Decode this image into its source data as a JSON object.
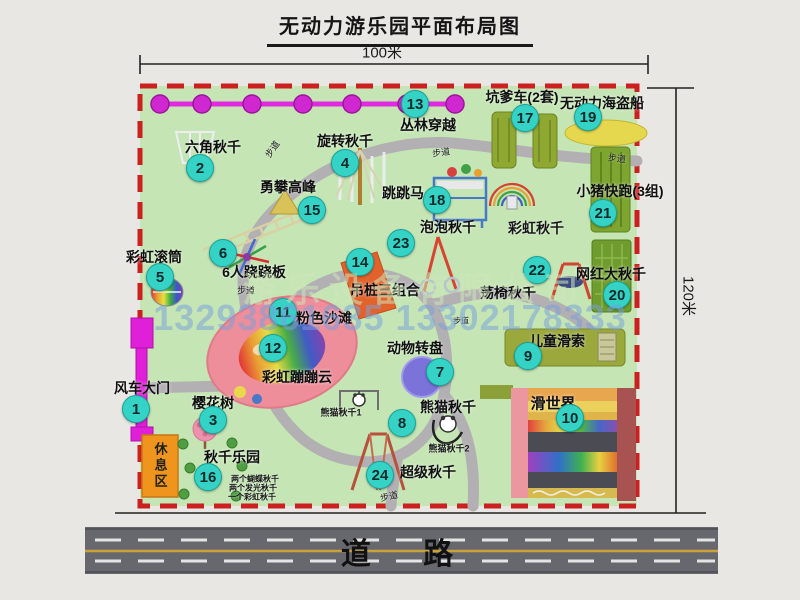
{
  "title": "无动力游乐园平面布局图",
  "dimensions": {
    "width_label": "100米",
    "height_label": "120米"
  },
  "road": {
    "label": "道 路"
  },
  "rest_area": {
    "label": "休息区"
  },
  "watermark": {
    "company": "游乐设备有限公司",
    "phone": "13293861635 13302178333"
  },
  "colors": {
    "map_green": "#c5e5b5",
    "border_red": "#cc1f1f",
    "badge_cyan": "#35d2c6",
    "chain_pink": "#d028d0",
    "road_gray": "#67676e",
    "gate_magenta": "#e020d8",
    "rest_orange": "#ef941d",
    "walkway_gray": "#b2b0b2"
  },
  "map": {
    "items": [
      {
        "num": 1,
        "name": "风车大门",
        "bx": 136,
        "by": 409,
        "lx": 142,
        "ly": 388
      },
      {
        "num": 2,
        "name": "六角秋千",
        "bx": 200,
        "by": 168,
        "lx": 213,
        "ly": 147
      },
      {
        "num": 3,
        "name": "樱花树",
        "bx": 213,
        "by": 420,
        "lx": 213,
        "ly": 403
      },
      {
        "num": 4,
        "name": "旋转秋千",
        "bx": 345,
        "by": 163,
        "lx": 345,
        "ly": 141
      },
      {
        "num": 5,
        "name": "彩虹滚筒",
        "bx": 160,
        "by": 277,
        "lx": 154,
        "ly": 257
      },
      {
        "num": 6,
        "name": "6人跷跷板",
        "bx": 223,
        "by": 253,
        "lx": 254,
        "ly": 272
      },
      {
        "num": 7,
        "name": "动物转盘",
        "bx": 440,
        "by": 372,
        "lx": 415,
        "ly": 348
      },
      {
        "num": 8,
        "name": "熊猫秋千",
        "bx": 402,
        "by": 423,
        "lx": 448,
        "ly": 407
      },
      {
        "num": 9,
        "name": "儿童滑索",
        "bx": 528,
        "by": 356,
        "lx": 557,
        "ly": 341
      },
      {
        "num": 10,
        "name": "滑世界",
        "bx": 570,
        "by": 418,
        "lx": 553,
        "ly": 403,
        "size": 15
      },
      {
        "num": 11,
        "name": "粉色沙滩",
        "bx": 283,
        "by": 312,
        "lx": 324,
        "ly": 318
      },
      {
        "num": 12,
        "name": "彩虹蹦蹦云",
        "bx": 273,
        "by": 348,
        "lx": 297,
        "ly": 377
      },
      {
        "num": 13,
        "name": "丛林穿越",
        "bx": 415,
        "by": 104,
        "lx": 428,
        "ly": 125
      },
      {
        "num": 14,
        "name": "吊桩三组合",
        "bx": 360,
        "by": 262,
        "lx": 385,
        "ly": 290
      },
      {
        "num": 15,
        "name": "勇攀高峰",
        "bx": 312,
        "by": 210,
        "lx": 288,
        "ly": 187
      },
      {
        "num": 16,
        "name": "秋千乐园",
        "bx": 208,
        "by": 477,
        "lx": 232,
        "ly": 457
      },
      {
        "num": 17,
        "name": "坑爹车(2套)",
        "bx": 525,
        "by": 118,
        "lx": 522,
        "ly": 97
      },
      {
        "num": 18,
        "name": "跳跳马",
        "bx": 437,
        "by": 200,
        "lx": 403,
        "ly": 193
      },
      {
        "num": 19,
        "name": "无动力海盗船",
        "bx": 588,
        "by": 117,
        "lx": 602,
        "ly": 103
      },
      {
        "num": 20,
        "name": "网红大秋千",
        "bx": 617,
        "by": 295,
        "lx": 611,
        "ly": 274
      },
      {
        "num": 21,
        "name": "小猪快跑(3组)",
        "bx": 603,
        "by": 213,
        "lx": 620,
        "ly": 191
      },
      {
        "num": 22,
        "name": "荡椅秋千",
        "bx": 537,
        "by": 270,
        "lx": 508,
        "ly": 293
      },
      {
        "num": 23,
        "name": "泡泡秋千",
        "bx": 401,
        "by": 243,
        "lx": 448,
        "ly": 227
      },
      {
        "num": 24,
        "name": "超级秋千",
        "bx": 380,
        "by": 475,
        "lx": 428,
        "ly": 472
      }
    ],
    "notes": [
      {
        "text": "彩虹秋千",
        "x": 536,
        "y": 228,
        "size": 14,
        "bold": true,
        "name": "rainbow-swing-label"
      },
      {
        "text": "熊猫秋千1",
        "x": 341,
        "y": 412,
        "size": 9,
        "bold": true,
        "name": "panda-swing-1-label"
      },
      {
        "text": "熊猫秋千2",
        "x": 449,
        "y": 448,
        "size": 9,
        "bold": true,
        "name": "panda-swing-2-label"
      },
      {
        "text": "两个蝴蝶秋千",
        "x": 255,
        "y": 479,
        "size": 8,
        "bold": true,
        "name": "swing-park-note-1"
      },
      {
        "text": "两个发光秋千",
        "x": 253,
        "y": 488,
        "size": 8,
        "bold": true,
        "name": "swing-park-note-2"
      },
      {
        "text": "一个彩虹秋千",
        "x": 252,
        "y": 497,
        "size": 8,
        "bold": true,
        "name": "swing-park-note-3"
      },
      {
        "text": "步道",
        "x": 272,
        "y": 149,
        "size": 9,
        "rot": -55,
        "name": "walkway-label-1"
      },
      {
        "text": "步道",
        "x": 441,
        "y": 152,
        "size": 9,
        "rot": -8,
        "name": "walkway-label-2"
      },
      {
        "text": "步道",
        "x": 617,
        "y": 158,
        "size": 9,
        "rot": 6,
        "name": "walkway-label-3"
      },
      {
        "text": "步道",
        "x": 246,
        "y": 290,
        "size": 9,
        "rot": 0,
        "name": "walkway-label-4"
      },
      {
        "text": "步道",
        "x": 461,
        "y": 321,
        "size": 8,
        "rot": 0,
        "name": "walkway-label-5"
      },
      {
        "text": "步道",
        "x": 389,
        "y": 496,
        "size": 9,
        "rot": -12,
        "name": "walkway-label-6"
      }
    ]
  }
}
